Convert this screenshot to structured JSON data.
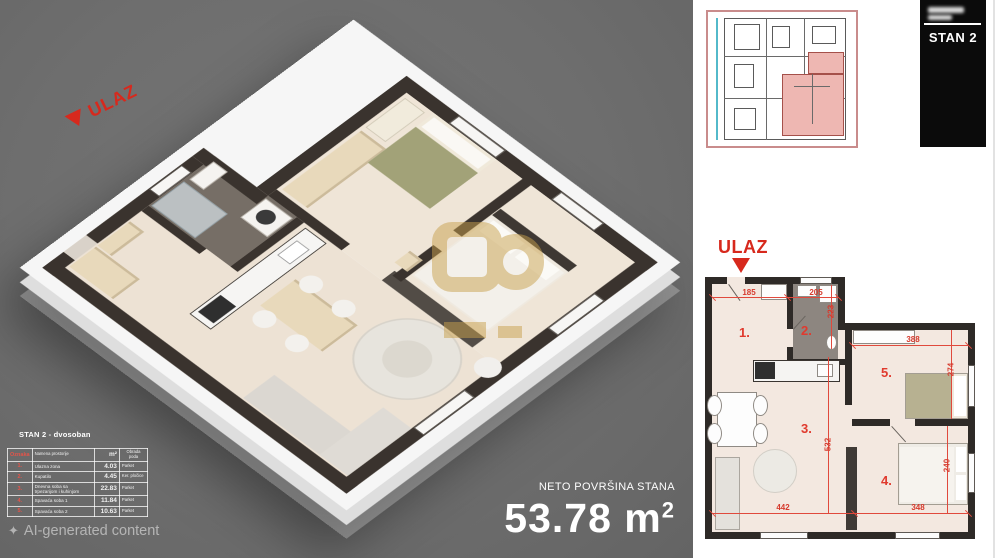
{
  "left_panel": {
    "entrance_label": "ULAZ",
    "sparkle_icon": "✦",
    "ai_watermark": "AI-generated content",
    "area_caption": "NETO POVRŠINA STANA",
    "area_value": "53.78",
    "area_unit": "m",
    "area_exp": "2",
    "table": {
      "title": "STAN 2 - dvosoban",
      "headers": [
        "Oznaka",
        "Namena prostorije",
        "m²",
        "Obrada poda"
      ],
      "rows": [
        {
          "num": "1.",
          "name": "Ulazna zona",
          "area": "4.03",
          "floor": "Parket"
        },
        {
          "num": "2.",
          "name": "Kupatilo",
          "area": "4.45",
          "floor": "Ker. pločice"
        },
        {
          "num": "3.",
          "name": "Dnevna soba sa trpezarijom i kuhinjom",
          "area": "22.83",
          "floor": "Parket"
        },
        {
          "num": "4.",
          "name": "Spavaća soba 1",
          "area": "11.84",
          "floor": "Parket"
        },
        {
          "num": "5.",
          "name": "Spavaća soba 2",
          "area": "10.63",
          "floor": "Parket"
        }
      ]
    }
  },
  "right_panel": {
    "unit_badge": "STAN 2",
    "entrance_label": "ULAZ",
    "room_numbers": [
      "1.",
      "2.",
      "3.",
      "4.",
      "5."
    ],
    "dimensions": {
      "hall_width": "185",
      "bath_width": "205",
      "hall_depth": "223",
      "room5_width": "388",
      "room5_depth": "274",
      "living_depth": "532",
      "bed_depth": "240",
      "living_width": "442",
      "room4_width": "348"
    }
  },
  "colors": {
    "background_gray": "#6e6e6e",
    "accent_red": "#d7291d",
    "dimension_red": "#e0493c",
    "wall_dark": "#2e2a27",
    "floor_beige": "#f2e7dd",
    "watermark_gold": "#c7a04d",
    "minimap_highlight_pink": "#eeb7b2"
  }
}
